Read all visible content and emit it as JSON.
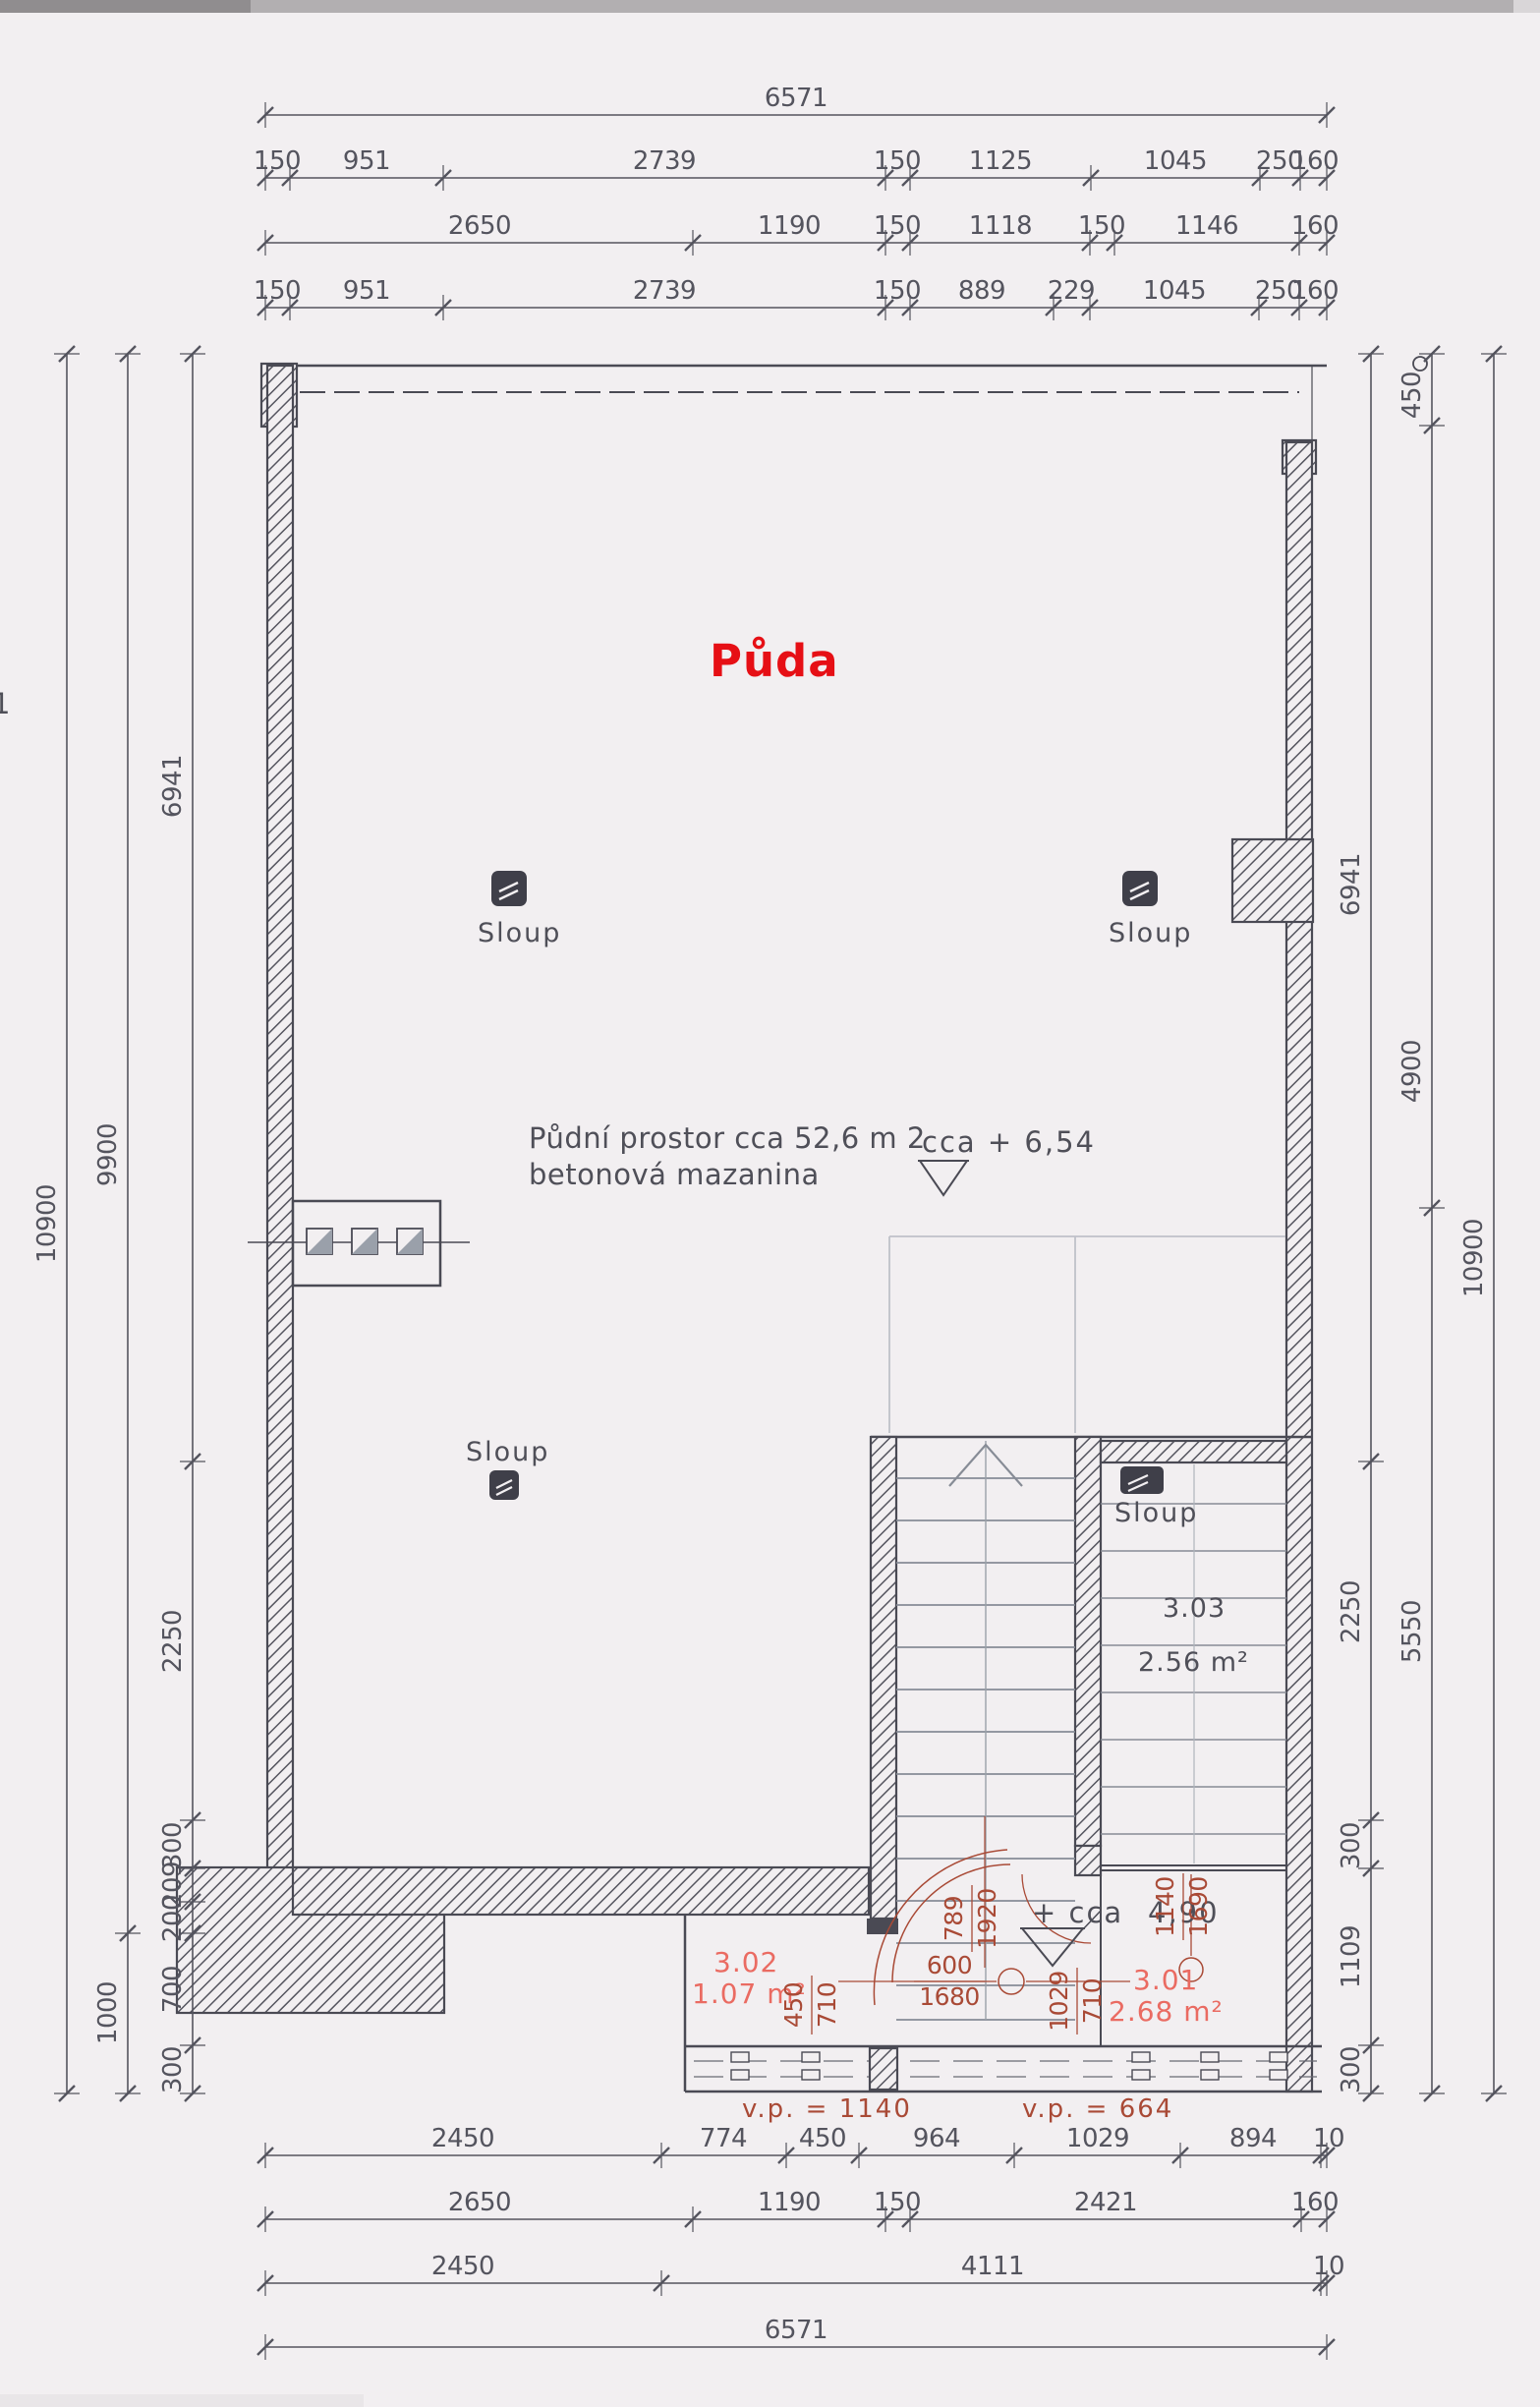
{
  "title": "Půda",
  "edge_mark": "1",
  "columns": {
    "label": "Sloup"
  },
  "notes": {
    "area_line1": "Půdní prostor  cca 52,6 m 2",
    "area_line2": "betonová mazanina"
  },
  "levels": {
    "upper": "cca  +  6,54",
    "lower_prefix": "+  cca",
    "lower_value": "4,90"
  },
  "rooms": {
    "r303": {
      "no": "3.03",
      "area": "2.56  m²"
    },
    "r302": {
      "no": "3.02",
      "area": "1.07  m²"
    },
    "r301": {
      "no": "3.01",
      "area": "2.68  m²"
    }
  },
  "vp": {
    "left": "v.p.  =  1140",
    "right": "v.p.  =  664"
  },
  "doors": {
    "d1": {
      "a": "450",
      "b": "710"
    },
    "d2": {
      "a": "789",
      "b": "1920"
    },
    "d3": {
      "a": "600",
      "b": "1680"
    },
    "d4": {
      "a": "1029",
      "b": "710"
    },
    "d5": {
      "a": "1140",
      "b": "1690"
    }
  },
  "dims": {
    "top1": [
      "6571"
    ],
    "top2": [
      "150",
      "951",
      "2739",
      "150",
      "1125",
      "1045",
      "250",
      "160"
    ],
    "top3": [
      "2650",
      "1190",
      "150",
      "1118",
      "150",
      "1146",
      "160"
    ],
    "top4": [
      "150",
      "951",
      "2739",
      "150",
      "889",
      "229",
      "1045",
      "250",
      "160"
    ],
    "bottom1": [
      "2450",
      "774",
      "450",
      "964",
      "1029",
      "894",
      "10"
    ],
    "bottom2": [
      "2650",
      "1190",
      "150",
      "2421",
      "160"
    ],
    "bottom3": [
      "2450",
      "4111",
      "10"
    ],
    "bottom4": [
      "6571"
    ],
    "left_outer": [
      "10900"
    ],
    "left_mid": [
      "9900",
      "1000"
    ],
    "left_inner": [
      "6941",
      "2250",
      "300",
      "209",
      "200",
      "700",
      "300"
    ],
    "right_inner": [
      "6941",
      "2250",
      "300",
      "1109",
      "300"
    ],
    "right_mid": [
      "450",
      "4900",
      "5550"
    ],
    "right_outer": [
      "10900"
    ]
  }
}
